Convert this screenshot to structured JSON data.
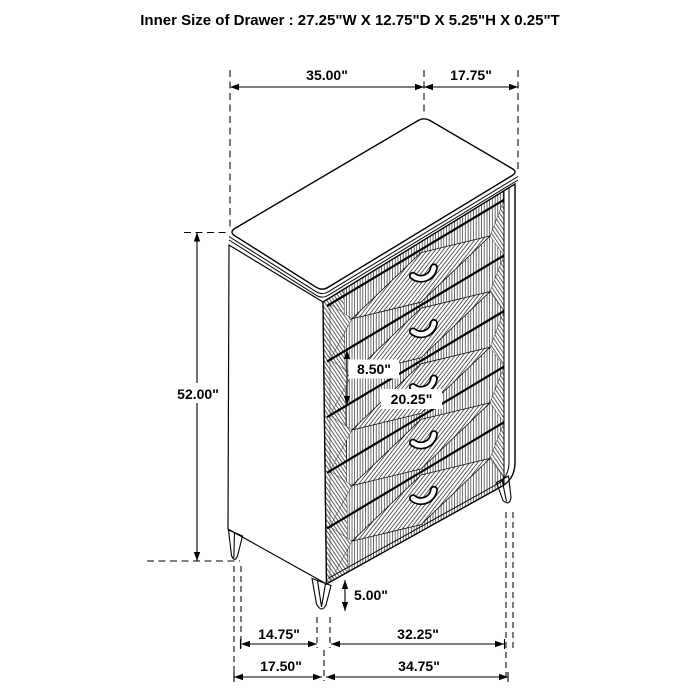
{
  "title": "Inner Size of Drawer : 27.25\"W X 12.75\"D X 5.25\"H X 0.25\"T",
  "dimensions": {
    "top_width": "35.00\"",
    "top_depth": "17.75\"",
    "overall_height": "52.00\"",
    "drawer_front_height": "8.50\"",
    "drawer_front_width": "20.25\"",
    "leg_height": "5.00\"",
    "leg_span_side": "14.75\"",
    "leg_span_front": "32.25\"",
    "base_depth": "17.50\"",
    "base_width": "34.75\""
  }
}
